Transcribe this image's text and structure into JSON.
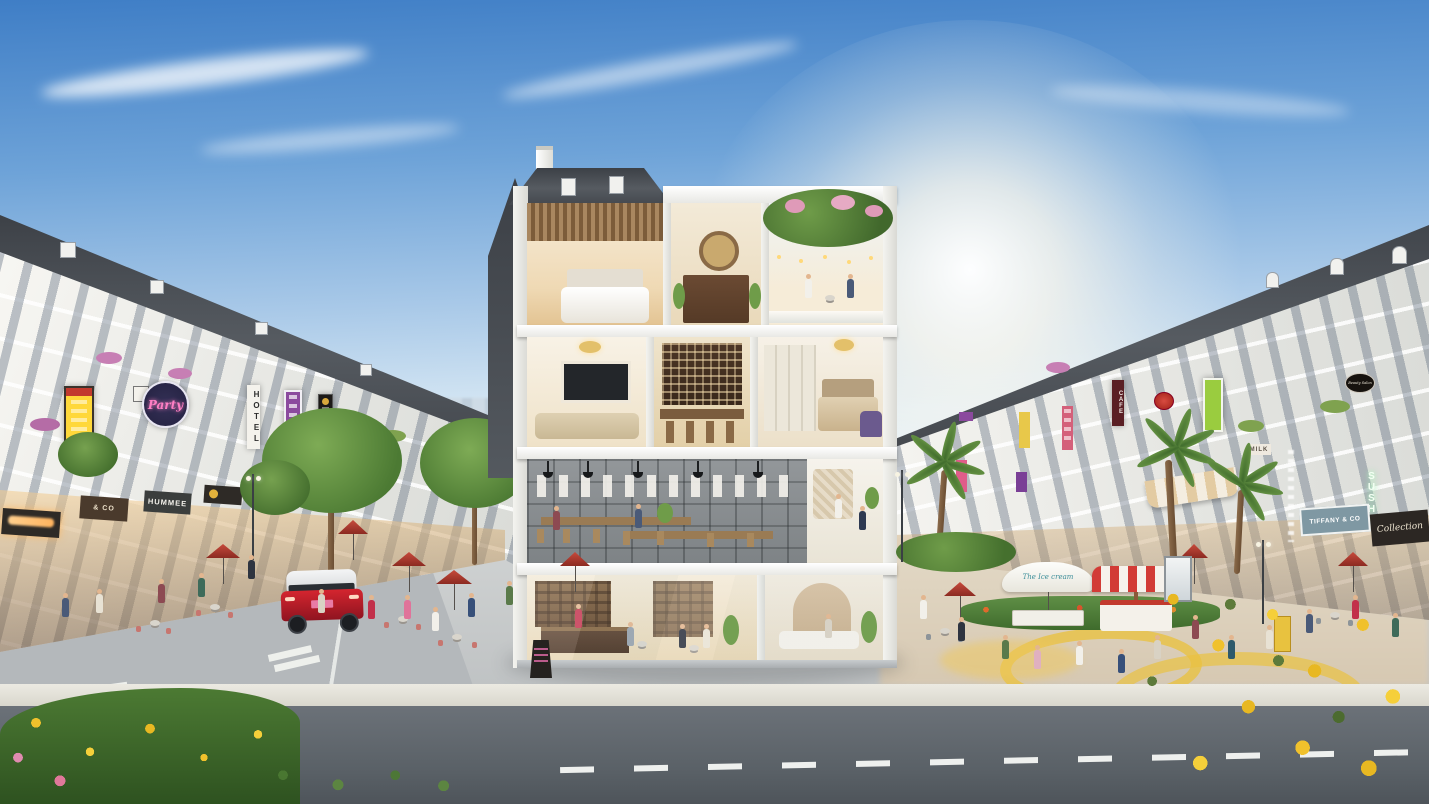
{
  "scene": {
    "title": "Shophouse boulevard 3D render with four-storey cutaway section building",
    "description": "Sunny architectural rendering: two rows of white neoclassical shophouses with slate mansard roofs flank a pedestrian shopping street. In the center a four-storey shophouse is cut away showing a ground-floor coffee shop, a co-working cafe level, a family living level with wine bar and bedroom, and a top level with bedroom, altar room and rooftop flower terrace. A red SUV drives on the left street; crowds shop under red cafe umbrellas; an ice-cream cart with striped canopy stands on the right plaza; golden-shower flowers frame the foreground road.",
    "floors_bottom_to_top": [
      "Ground floor: coffee shop with counter, shelves and lounge with arched niche",
      "Second floor: co-working / community cafe with long wood tables and poster wall",
      "Third floor: living room with TV, wine rack bar and master bedroom",
      "Fourth floor: bedroom with slatted ceiling, altar room, rooftop terrace under flower pergola"
    ]
  },
  "signs": {
    "party": "Party",
    "hotel": "HOTEL",
    "hummee": "HUMMEE",
    "and_co": "& CO",
    "cafe": "CAFE",
    "milk": "MILK",
    "sushi": "SUSHI",
    "tiffany": "TIFFANY & CO",
    "collection": "Collection",
    "beauty_salon": "Beauty Salon",
    "ice_cream_umbrella": "The Ice cream"
  },
  "palette": {
    "sky_top": "#3f7ec6",
    "sky_horizon": "#f6f9fa",
    "sun_glow": "#ffffff",
    "facade_white": "#f4f3ef",
    "roof_slate": "#44484e",
    "foliage_green": "#5f8f46",
    "golden_flowers": "#e8b822",
    "red_umbrella": "#b5342c",
    "suv_red": "#c0182a",
    "plaza_gray": "#c9cccc",
    "asphalt": "#5c6268",
    "warm_interior": "#f5dfb8"
  },
  "vehicles": {
    "suv_color_name": "red SUV"
  }
}
